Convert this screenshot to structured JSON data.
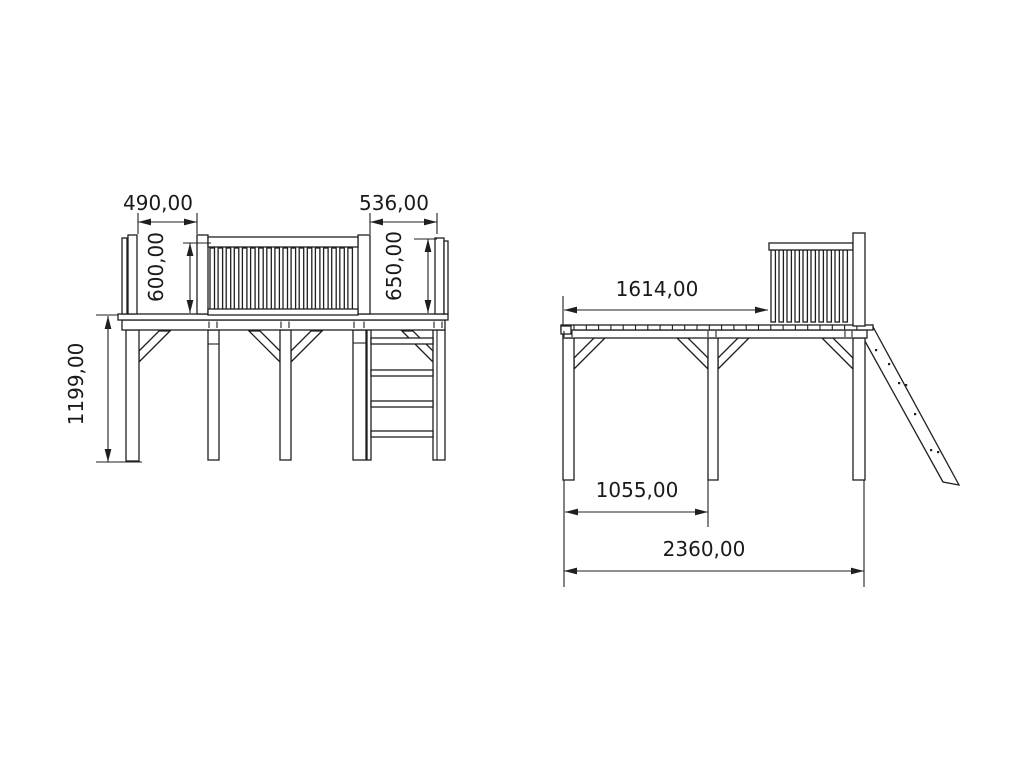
{
  "drawing": {
    "title": "play-tower-technical-drawing",
    "background": "#ffffff",
    "line_color": "#1f1f1f",
    "left_view": {
      "dim_opening_left": "490,00",
      "dim_opening_right": "536,00",
      "dim_rail_height_left": "600,00",
      "dim_rail_height_right": "650,00",
      "dim_platform_height": "1199,00"
    },
    "right_view": {
      "dim_platform_length": "1614,00",
      "dim_post_spacing": "1055,00",
      "dim_total_length": "2360,00"
    }
  }
}
